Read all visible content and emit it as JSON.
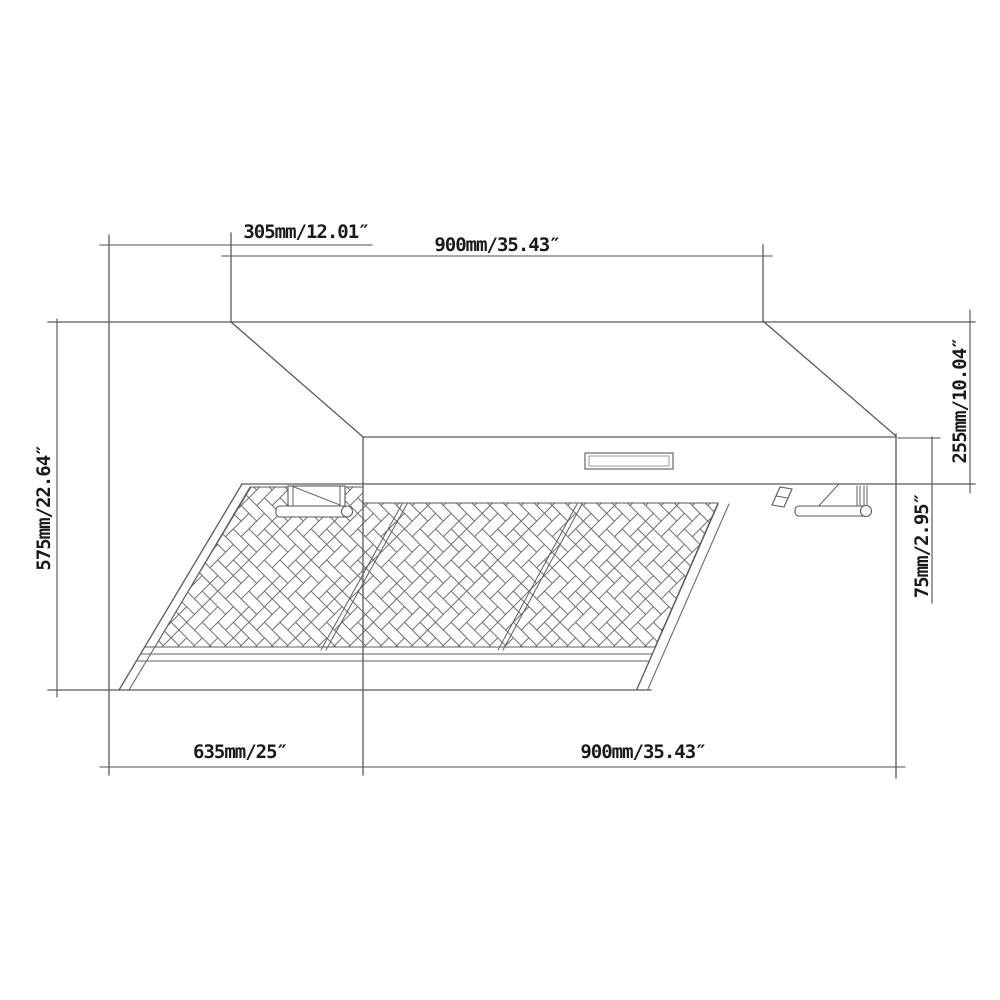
{
  "document": {
    "kind": "technical dimension drawing",
    "subject": "under-cabinet range hood with baffle filters",
    "background_color": "#ffffff",
    "line_color": "#5a5a5a",
    "text_color": "#1a1a1a"
  },
  "dimensions": {
    "top_depth_offset": "305mm/12.01″",
    "top_width": "900mm/35.43″",
    "side_height": "575mm/22.64″",
    "front_total_height": "255mm/10.04″",
    "front_lip_height": "75mm/2.95″",
    "bottom_depth": "635mm/25″",
    "bottom_width": "900mm/35.43″"
  },
  "features": {
    "filter_panels_count": 3,
    "filter_pattern": "herringbone mesh",
    "control_panel": "blank recessed rectangle on front face",
    "handle_rails": "left and right cylindrical rails with mounting brackets"
  }
}
